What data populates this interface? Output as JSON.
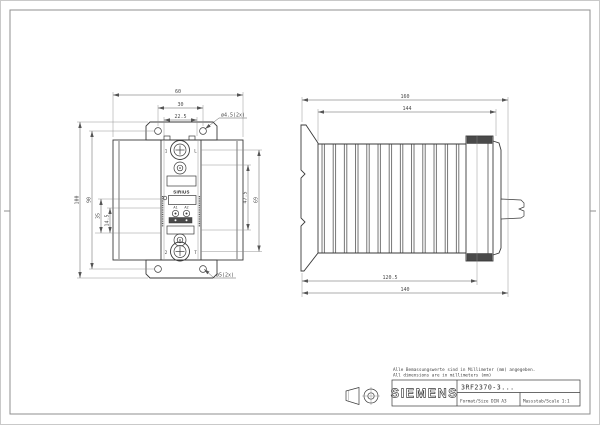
{
  "drawing": {
    "front_view": {
      "dims": {
        "width_outer": "60",
        "width_mid": "30",
        "width_inner": "22.5",
        "height_outer": "100",
        "height_mid": "90",
        "left_a": "35",
        "left_b": "14.5",
        "right_inner": "47.5",
        "right_outer": "69",
        "hole_top": "ø4.5(2x)",
        "hole_bottom": "ø5(2x)"
      },
      "device": {
        "brand": "SIRIUS",
        "pole1": "1",
        "pole1_line": "L",
        "pole2": "2",
        "pole2_line": "T",
        "ctrl1": "A1",
        "ctrl2": "A2"
      }
    },
    "side_view": {
      "dims": {
        "depth_outer": "160",
        "depth_inner": "144",
        "bottom_inner": "120.5",
        "bottom_outer": "140"
      }
    },
    "notes": {
      "de": "Alle Bemassungswerte sind in Millimeter (mm) angegeben.",
      "en": "All dimensions are in millimeters (mm)"
    },
    "title_block": {
      "brand": "SIEMENS",
      "order_number": "3RF2370-3...",
      "format": "Format/Size DIN A3",
      "scale": "Massstab/Scale 1:1"
    }
  }
}
